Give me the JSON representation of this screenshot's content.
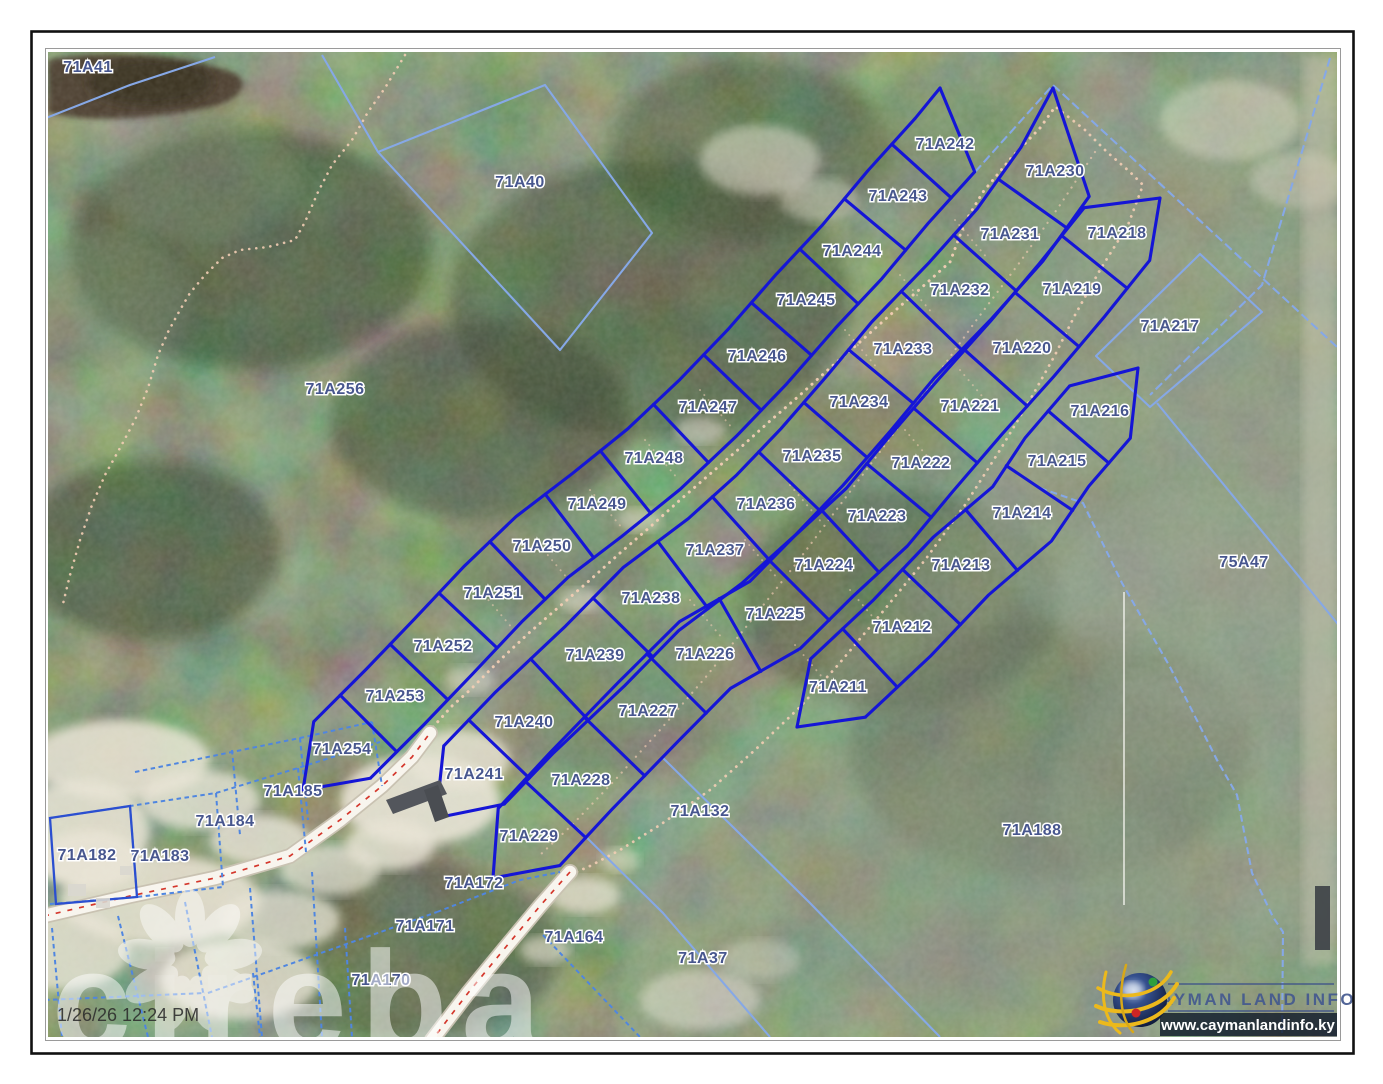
{
  "map": {
    "timestamp": "1/26/26 12:24 PM",
    "watermark_text": "cireba",
    "colors": {
      "parcel_bold": "#1515d6",
      "parcel_light": "#86a8e6",
      "parcel_dashed": "#4f86e0",
      "label": "#47568e",
      "road_fill": "#f8f5ee",
      "road_center": "#d4372c",
      "trail_dot": "#f2cdb4"
    },
    "parcel_labels": [
      {
        "id": "71A41",
        "x": 88,
        "y": 68
      },
      {
        "id": "71A40",
        "x": 520,
        "y": 183
      },
      {
        "id": "71A256",
        "x": 335,
        "y": 390
      },
      {
        "id": "71A242",
        "x": 945,
        "y": 145
      },
      {
        "id": "71A243",
        "x": 898,
        "y": 197
      },
      {
        "id": "71A244",
        "x": 852,
        "y": 252
      },
      {
        "id": "71A245",
        "x": 806,
        "y": 301
      },
      {
        "id": "71A246",
        "x": 757,
        "y": 357
      },
      {
        "id": "71A247",
        "x": 708,
        "y": 408
      },
      {
        "id": "71A248",
        "x": 654,
        "y": 459
      },
      {
        "id": "71A249",
        "x": 597,
        "y": 505
      },
      {
        "id": "71A250",
        "x": 542,
        "y": 547
      },
      {
        "id": "71A251",
        "x": 493,
        "y": 594
      },
      {
        "id": "71A252",
        "x": 443,
        "y": 647
      },
      {
        "id": "71A253",
        "x": 395,
        "y": 697
      },
      {
        "id": "71A254",
        "x": 342,
        "y": 750
      },
      {
        "id": "71A230",
        "x": 1055,
        "y": 172
      },
      {
        "id": "71A231",
        "x": 1010,
        "y": 235
      },
      {
        "id": "71A232",
        "x": 960,
        "y": 291
      },
      {
        "id": "71A233",
        "x": 903,
        "y": 350
      },
      {
        "id": "71A234",
        "x": 859,
        "y": 403
      },
      {
        "id": "71A235",
        "x": 812,
        "y": 457
      },
      {
        "id": "71A236",
        "x": 766,
        "y": 505
      },
      {
        "id": "71A237",
        "x": 715,
        "y": 551
      },
      {
        "id": "71A238",
        "x": 651,
        "y": 599
      },
      {
        "id": "71A239",
        "x": 595,
        "y": 656
      },
      {
        "id": "71A240",
        "x": 524,
        "y": 723
      },
      {
        "id": "71A241",
        "x": 474,
        "y": 775
      },
      {
        "id": "71A218",
        "x": 1117,
        "y": 234
      },
      {
        "id": "71A219",
        "x": 1072,
        "y": 290
      },
      {
        "id": "71A220",
        "x": 1022,
        "y": 349
      },
      {
        "id": "71A221",
        "x": 970,
        "y": 407
      },
      {
        "id": "71A222",
        "x": 921,
        "y": 464
      },
      {
        "id": "71A223",
        "x": 877,
        "y": 517
      },
      {
        "id": "71A224",
        "x": 824,
        "y": 566
      },
      {
        "id": "71A225",
        "x": 775,
        "y": 615
      },
      {
        "id": "71A226",
        "x": 705,
        "y": 655
      },
      {
        "id": "71A227",
        "x": 648,
        "y": 712
      },
      {
        "id": "71A228",
        "x": 581,
        "y": 781
      },
      {
        "id": "71A229",
        "x": 529,
        "y": 837
      },
      {
        "id": "71A216",
        "x": 1100,
        "y": 412
      },
      {
        "id": "71A215",
        "x": 1057,
        "y": 462
      },
      {
        "id": "71A214",
        "x": 1022,
        "y": 514
      },
      {
        "id": "71A213",
        "x": 961,
        "y": 566
      },
      {
        "id": "71A212",
        "x": 902,
        "y": 628
      },
      {
        "id": "71A211",
        "x": 838,
        "y": 688
      },
      {
        "id": "71A217",
        "x": 1170,
        "y": 327
      },
      {
        "id": "75A47",
        "x": 1244,
        "y": 563
      },
      {
        "id": "71A188",
        "x": 1032,
        "y": 831
      },
      {
        "id": "71A132",
        "x": 700,
        "y": 812
      },
      {
        "id": "71A185",
        "x": 293,
        "y": 792
      },
      {
        "id": "71A184",
        "x": 225,
        "y": 822
      },
      {
        "id": "71A183",
        "x": 160,
        "y": 857
      },
      {
        "id": "71A182",
        "x": 87,
        "y": 856
      },
      {
        "id": "71A172",
        "x": 474,
        "y": 884
      },
      {
        "id": "71A171",
        "x": 425,
        "y": 927
      },
      {
        "id": "71A170",
        "x": 381,
        "y": 981
      },
      {
        "id": "71A164",
        "x": 574,
        "y": 938
      },
      {
        "id": "71A37",
        "x": 703,
        "y": 959
      }
    ]
  },
  "branding": {
    "logo_title": "CAYMAN LAND INFO",
    "logo_url": "www.caymanlandinfo.ky"
  }
}
